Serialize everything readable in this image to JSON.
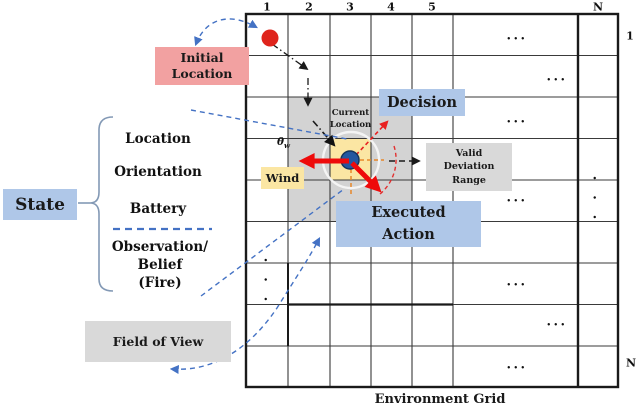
{
  "colors": {
    "box-blue": "#AFC7E8",
    "box-pink": "#F2A1A1",
    "box-yellow": "#FBE6A3",
    "box-gray": "#D9D9D9",
    "cell-gray": "#D3D3D3",
    "cell-yellow": "#FBE6A3",
    "arrow-red": "#EE0A0A",
    "dash-red": "#E82020",
    "dash-blue": "#4472C4",
    "dash-orange": "#E8882A",
    "dot-red": "#DF241C",
    "dot-blue": "#2458A0",
    "grid-line": "#3A3A3A"
  },
  "grid": {
    "col_labels": [
      "1",
      "2",
      "3",
      "4",
      "5",
      "N"
    ],
    "row_labels": [
      "1",
      "N"
    ],
    "caption": "Environment Grid",
    "ellipsis": "...",
    "current_cell_label": "Current Location"
  },
  "labels": {
    "initial_location": "Initial Location",
    "decision": "Decision",
    "wind": "Wind",
    "theta": "θ",
    "theta_sub": "w",
    "valid_deviation_range": "Valid Deviation Range",
    "executed_action": "Executed Action",
    "field_of_view": "Field of View"
  },
  "state": {
    "title": "State",
    "items": [
      "Location",
      "Orientation",
      "Battery"
    ],
    "belief_lines": [
      "Observation/",
      "Belief",
      "(Fire)"
    ]
  }
}
